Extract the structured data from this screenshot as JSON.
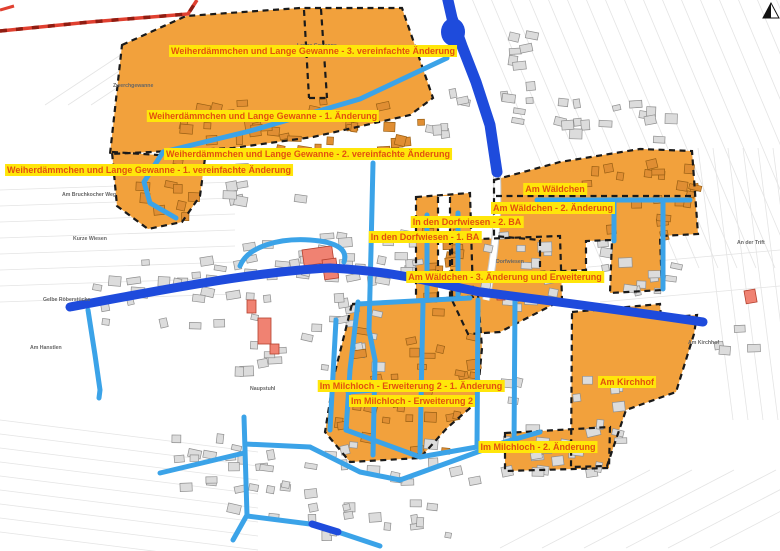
{
  "map": {
    "type": "zoning-overview-map",
    "plan_labels": [
      {
        "text": "Weiherdämmchen und Lange Gewanne - 3. vereinfachte Änderung",
        "x": 313,
        "y": 51
      },
      {
        "text": "Weiherdämmchen und Lange Gewanne - 1. Änderung",
        "x": 263,
        "y": 116
      },
      {
        "text": "Weiherdämmchen und Lange Gewanne - 2. vereinfachte Änderung",
        "x": 308,
        "y": 154
      },
      {
        "text": "Weiherdämmchen und Lange Gewanne - 1. vereinfachte Änderung",
        "x": 149,
        "y": 170
      },
      {
        "text": "Am Wäldchen",
        "x": 555,
        "y": 189
      },
      {
        "text": "Am Wäldchen - 2. Änderung",
        "x": 553,
        "y": 208
      },
      {
        "text": "In den Dorfwiesen - 2. BA",
        "x": 467,
        "y": 222
      },
      {
        "text": "In den Dorfwiesen - 1. BA",
        "x": 425,
        "y": 237
      },
      {
        "text": "Am Wäldchen - 3. Änderung und Erweiterung",
        "x": 505,
        "y": 277
      },
      {
        "text": "Im Milchloch - Erweiterung 2 - 1. Änderung",
        "x": 411,
        "y": 386
      },
      {
        "text": "Im Milchloch - Erweiterung 2",
        "x": 412,
        "y": 401
      },
      {
        "text": "Am Kirchhof",
        "x": 627,
        "y": 382
      },
      {
        "text": "Im Milchloch - 2. Änderung",
        "x": 538,
        "y": 447
      }
    ],
    "field_labels": [
      {
        "text": "Lange Gewanne",
        "x": 297,
        "y": 47
      },
      {
        "text": "Zwerchgewanne",
        "x": 113,
        "y": 87
      },
      {
        "text": "Am Bruchkocher Weg",
        "x": 62,
        "y": 196
      },
      {
        "text": "Kurze Wiesen",
        "x": 73,
        "y": 240
      },
      {
        "text": "Gelbe Röberstücke",
        "x": 43,
        "y": 301
      },
      {
        "text": "Am Hanstlen",
        "x": 30,
        "y": 349
      },
      {
        "text": "Naupstuhl",
        "x": 250,
        "y": 390
      },
      {
        "text": "Dorfwiesen",
        "x": 496,
        "y": 263
      },
      {
        "text": "An der Trift",
        "x": 737,
        "y": 244
      },
      {
        "text": "Am Kirchhof",
        "x": 688,
        "y": 344
      }
    ],
    "colors": {
      "zone_fill": "#F2A13C",
      "zone_border": "#1A1A1A",
      "road_major": "#1E4BDC",
      "road_minor": "#3BA3E8",
      "label_bg": "#FFE60A",
      "label_text": "#E2500F",
      "boundary_red": "#E04030",
      "boundary_red_dash": "#8F1D12",
      "building_fill": "#DCDCDC",
      "building_stroke": "#8F8F8F",
      "zone_building_fill": "#E08E33",
      "zone_building_stroke": "#9A6014",
      "public_building_fill": "#F08272",
      "public_building_stroke": "#B4402E",
      "parcel_line": "#E4E4E4",
      "field_label_text": "#666666"
    }
  }
}
